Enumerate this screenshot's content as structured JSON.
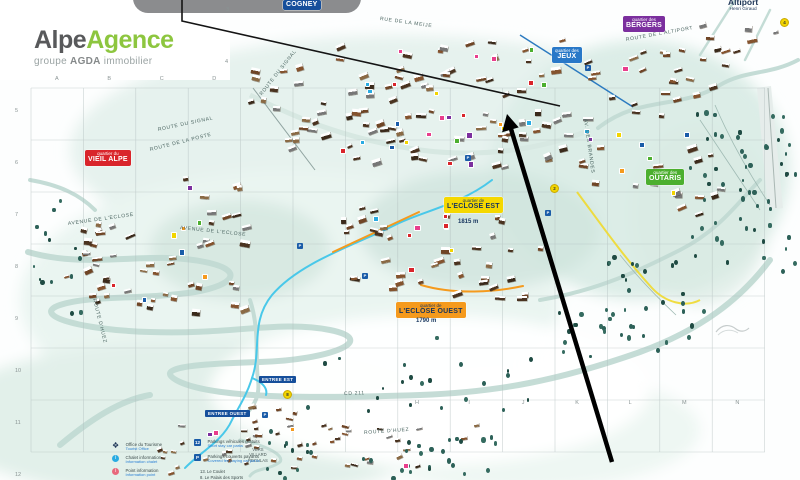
{
  "branding": {
    "name_part1": "Alpe",
    "name_part2": "Agence",
    "tagline_prefix": "groupe",
    "tagline_bold": "AGDA",
    "tagline_suffix": "immobilier"
  },
  "map": {
    "districts": [
      {
        "key": "cogney",
        "prefix": "",
        "name": "COGNEY",
        "color": "#164f9b",
        "text": "#ffffff"
      },
      {
        "key": "jeux",
        "prefix": "quartier des",
        "name": "JEUX",
        "color": "#2878c8",
        "text": "#ffffff"
      },
      {
        "key": "bergers",
        "prefix": "quartier des",
        "name": "BERGERS",
        "color": "#7b2f9e",
        "text": "#ffffff"
      },
      {
        "key": "vieil-alpe",
        "prefix": "quartier du",
        "name": "VIEIL ALPE",
        "color": "#d9252b",
        "text": "#ffffff"
      },
      {
        "key": "eclose-est",
        "prefix": "quartier de",
        "name": "L'ECLOSE EST",
        "color": "#f5d800",
        "text": "#17355e",
        "elevation": "1815 m"
      },
      {
        "key": "eclose-ouest",
        "prefix": "quartier de",
        "name": "L'ECLOSE OUEST",
        "color": "#f59a1d",
        "text": "#17355e",
        "elevation": "1790 m"
      },
      {
        "key": "outaris",
        "prefix": "quartier des",
        "name": "OUTARIS",
        "color": "#4caf2f",
        "text": "#ffffff"
      }
    ],
    "places": {
      "altiport_title": "Altiport",
      "altiport_subtitle": "Henri Giraud",
      "entree_est": "ENTREE EST",
      "entree_ouest": "ENTREE OUEST",
      "villard_line1": "VERS",
      "villard_line2": "VILLARD",
      "villard_line3": "RECULAS"
    },
    "streets": [
      "ROUTE DU SIGNAL",
      "ROUTE DE LA POSTE",
      "RUE DE LA MEIJE",
      "ROUTE DE L'ALTIPORT",
      "AVENUE DE L'ECLOSE",
      "AV. DES BRANDES",
      "ROUTE D'HUEZ",
      "CD 211"
    ],
    "grid": {
      "top_letters": [
        "A",
        "B",
        "C",
        "D"
      ],
      "bottom_letters": [
        "H",
        "I",
        "J",
        "K",
        "L",
        "M",
        "N"
      ],
      "left_numbers": [
        "5",
        "6",
        "7",
        "8",
        "9",
        "10",
        "11",
        "12"
      ],
      "inner_numbers": [
        "3",
        "4"
      ]
    },
    "numbered_markers": [
      "8",
      "2",
      "4"
    ],
    "parking_glyph": "P"
  },
  "legend": {
    "info_items": [
      {
        "icon": "office-tourisme",
        "label": "Office du Tourisme",
        "sublabel": "Tourist Office"
      },
      {
        "icon": "chalet-information",
        "label": "Chalet information",
        "sublabel": "Information chalet"
      },
      {
        "icon": "point-information",
        "label": "Point information",
        "sublabel": "Information point"
      }
    ],
    "parking_items": [
      {
        "badge": "12",
        "label": "Parkings véhicules gratuits",
        "sublabel": "Short stay car parks"
      },
      {
        "badge": "P",
        "label": "Parkings couverts payants",
        "sublabel": "Covered fee paying car parks"
      }
    ],
    "venues": [
      "13. Le Coulet",
      "8. Le Palais des Sports",
      "12. La Patinoire"
    ]
  },
  "colors": {
    "accent_green": "#8dc63f",
    "river": "#49c8e9",
    "route_orange": "#f59a1d",
    "route_yellow": "#f0d92e",
    "grid": "#b0bcbc",
    "arrow": "#000000"
  }
}
